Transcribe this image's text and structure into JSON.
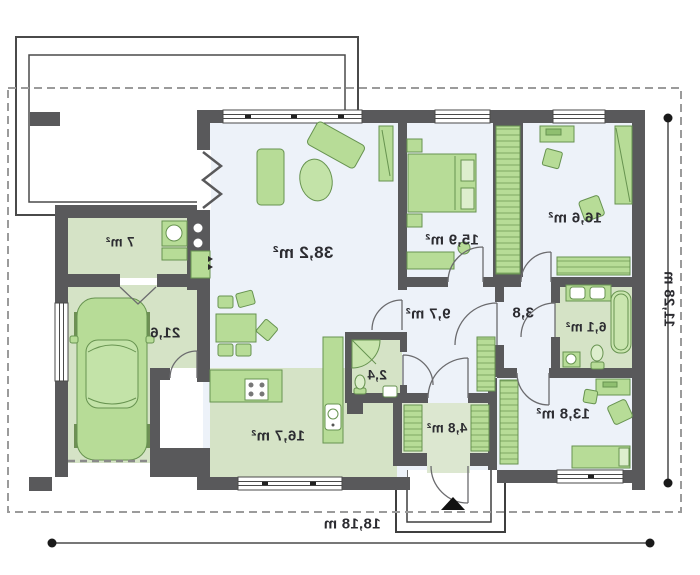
{
  "plan": {
    "type": "floor-plan",
    "orientation": "mirrored-print",
    "rooms": [
      {
        "id": "living-room",
        "area": "38,2 m²"
      },
      {
        "id": "bedroom-1",
        "area": "15,9 m²"
      },
      {
        "id": "bedroom-2",
        "area": "16,6 m²"
      },
      {
        "id": "hall",
        "area": "9,7 m²"
      },
      {
        "id": "corridor",
        "area": "3,8"
      },
      {
        "id": "bathroom",
        "area": "6,1 m²"
      },
      {
        "id": "bedroom-3",
        "area": "13,8 m²"
      },
      {
        "id": "entry",
        "area": "4,8 m²"
      },
      {
        "id": "wc",
        "area": "2,4"
      },
      {
        "id": "kitchen-dining",
        "area": "16,7 m²"
      },
      {
        "id": "garage",
        "area": "21,6"
      },
      {
        "id": "utility",
        "area": "7 m²"
      }
    ],
    "dimensions": {
      "total_width": "18,18 m",
      "total_height": "11,28 m"
    },
    "colors": {
      "wall": "#59595b",
      "floor_blue": "#edf2f9",
      "floor_green": "#d5e3c6",
      "furniture": "#b7dc97",
      "boundary_dash": "#9b9b9b"
    }
  }
}
